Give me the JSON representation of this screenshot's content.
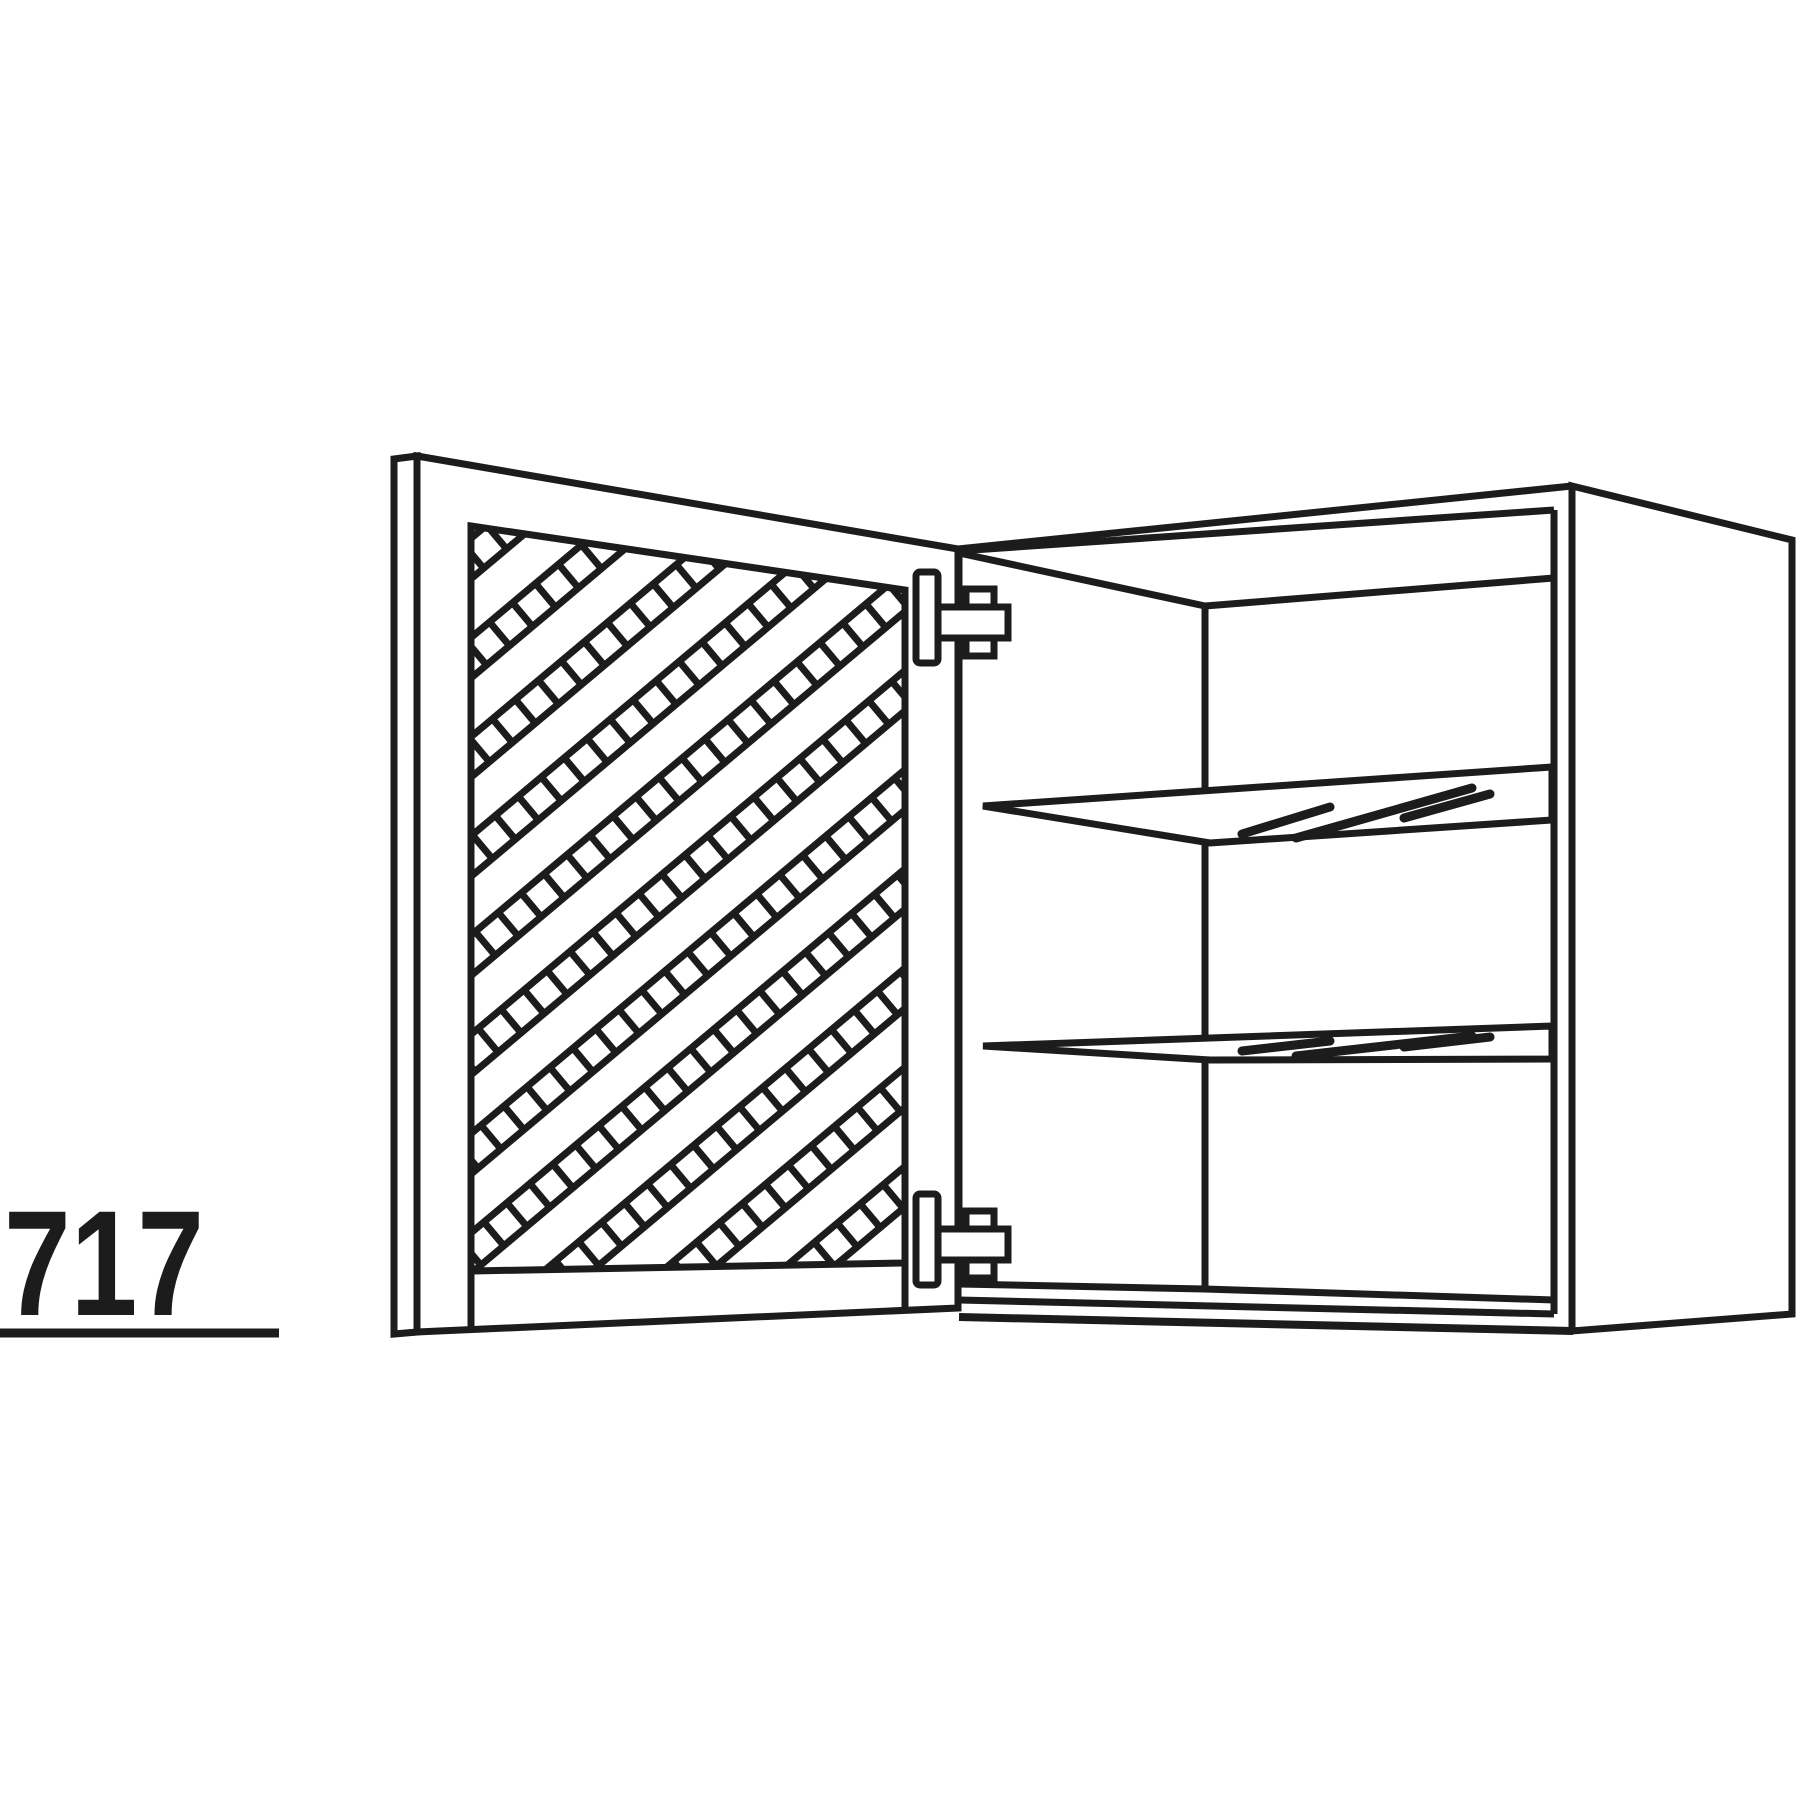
{
  "page": {
    "background_color": "#ffffff"
  },
  "diagram": {
    "kind": "technical-line-drawing",
    "subject": "wall cabinet with open diagonal-lattice door, two glass shelves and two hinges",
    "line_color": "#1c1c1c",
    "dimension": {
      "label": "717",
      "underlined": true
    },
    "parts": [
      "door-edge-strip",
      "door-frame",
      "door-lattice-panel",
      "top-hinge",
      "bottom-hinge",
      "cabinet-carcass",
      "right-side-panel",
      "glass-shelf-upper",
      "glass-shelf-lower",
      "bottom-panel",
      "dimension-label"
    ]
  }
}
